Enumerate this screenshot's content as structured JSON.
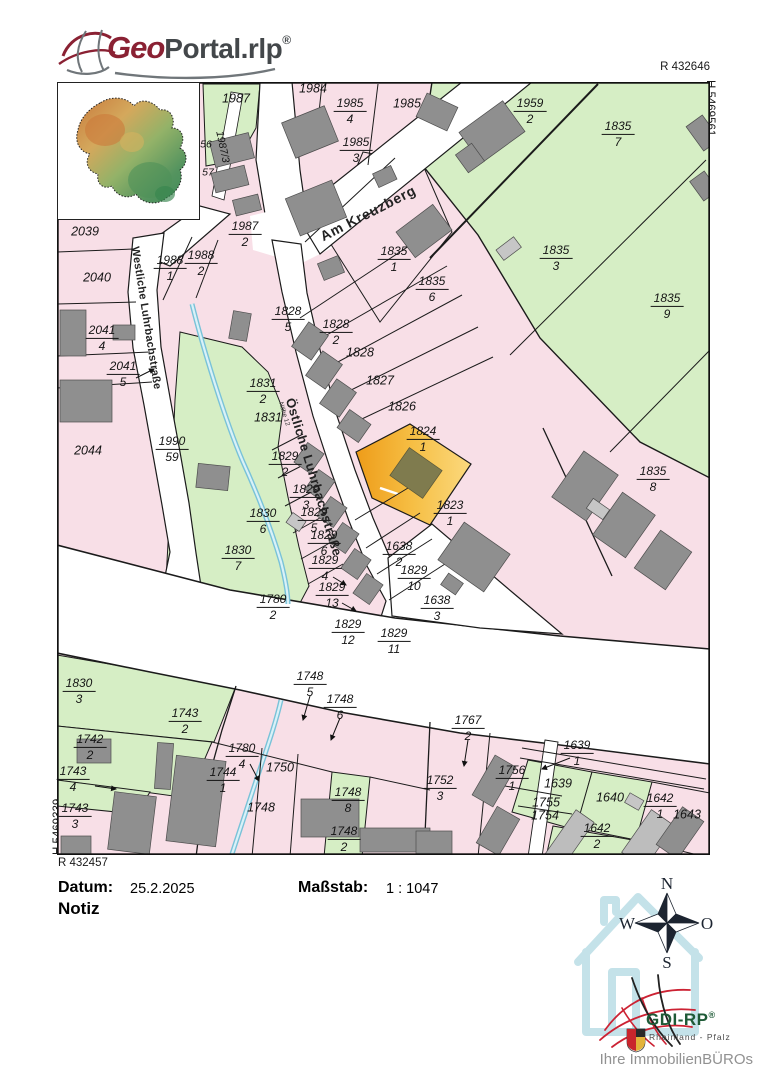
{
  "header": {
    "geo": "Geo",
    "portal": "Portal.rlp",
    "reg": "®"
  },
  "map": {
    "coords": {
      "top_r": "R 432646",
      "right_h": "H 5469561",
      "left_h": "H 5469339",
      "bottom_r": "R 432457"
    },
    "streets": {
      "am_kreuzberg": "Am Kreuzberg",
      "westliche": "Westliche Luhrbachstraße",
      "oestliche": "Östliche Luhrbachstraße",
      "naehe": "Nähe 12"
    },
    "highlight_parcel": "1824/1",
    "parcels": {
      "p1987": {
        "num": "1987"
      },
      "p1984": {
        "num": "1984"
      },
      "p1985_4": {
        "num": "1985",
        "den": "4"
      },
      "p1985": {
        "num": "1985"
      },
      "p1985_3": {
        "num": "1985",
        "den": "3"
      },
      "p1959_2": {
        "num": "1959",
        "den": "2"
      },
      "p1835_7": {
        "num": "1835",
        "den": "7"
      },
      "p1987_3": {
        "num": "1987/3"
      },
      "p56": {
        "num": "56"
      },
      "p57": {
        "num": "57"
      },
      "p2039": {
        "num": "2039"
      },
      "p1987_2": {
        "num": "1987",
        "den": "2"
      },
      "p1988_1": {
        "num": "1988",
        "den": "1"
      },
      "p1988_2": {
        "num": "1988",
        "den": "2"
      },
      "p2040": {
        "num": "2040"
      },
      "p1835_1": {
        "num": "1835",
        "den": "1"
      },
      "p1835_6": {
        "num": "1835",
        "den": "6"
      },
      "p1835_3": {
        "num": "1835",
        "den": "3"
      },
      "p1835_9": {
        "num": "1835",
        "den": "9"
      },
      "p1828_5": {
        "num": "1828",
        "den": "5"
      },
      "p1828_2": {
        "num": "1828",
        "den": "2"
      },
      "p1828": {
        "num": "1828"
      },
      "p2041_4": {
        "num": "2041",
        "den": "4"
      },
      "p1827": {
        "num": "1827"
      },
      "p1831_2": {
        "num": "1831",
        "den": "2"
      },
      "p2041_5": {
        "num": "2041",
        "den": "5"
      },
      "p1826": {
        "num": "1826"
      },
      "p1831": {
        "num": "1831"
      },
      "p1824_1": {
        "num": "1824",
        "den": "1"
      },
      "p2044": {
        "num": "2044"
      },
      "p1990_59": {
        "num": "1990",
        "den": "59"
      },
      "p1829_2": {
        "num": "1829",
        "den": "2"
      },
      "p1829_3": {
        "num": "1829",
        "den": "3"
      },
      "p1829_5": {
        "num": "1829",
        "den": "5"
      },
      "p1829_6": {
        "num": "1829",
        "den": "6"
      },
      "p1830_6": {
        "num": "1830",
        "den": "6"
      },
      "p1830_7": {
        "num": "1830",
        "den": "7"
      },
      "p1829_4": {
        "num": "1829",
        "den": "4"
      },
      "p1829_13": {
        "num": "1829",
        "den": "13"
      },
      "p1780_2": {
        "num": "1780",
        "den": "2"
      },
      "p1829_12": {
        "num": "1829",
        "den": "12"
      },
      "p1638_2": {
        "num": "1638",
        "den": "2"
      },
      "p1829_10": {
        "num": "1829",
        "den": "10"
      },
      "p1638_3": {
        "num": "1638",
        "den": "3"
      },
      "p1829_11": {
        "num": "1829",
        "den": "11"
      },
      "p1823_1": {
        "num": "1823",
        "den": "1"
      },
      "p1835_8": {
        "num": "1835",
        "den": "8"
      },
      "p1830_3": {
        "num": "1830",
        "den": "3"
      },
      "p1743_2": {
        "num": "1743",
        "den": "2"
      },
      "p1742_2": {
        "num": "1742",
        "den": "2"
      },
      "p1743_4": {
        "num": "1743",
        "den": "4"
      },
      "p1743_3": {
        "num": "1743",
        "den": "3"
      },
      "p1744_1": {
        "num": "1744",
        "den": "1"
      },
      "p1780_4": {
        "num": "1780",
        "den": "4"
      },
      "p1750": {
        "num": "1750"
      },
      "p1748": {
        "num": "1748"
      },
      "p1748_5": {
        "num": "1748",
        "den": "5"
      },
      "p1748_6": {
        "num": "1748",
        "den": "6"
      },
      "p1767_2": {
        "num": "1767",
        "den": "2"
      },
      "p1748_8": {
        "num": "1748",
        "den": "8"
      },
      "p1748_2": {
        "num": "1748",
        "den": "2"
      },
      "p1752_3": {
        "num": "1752",
        "den": "3"
      },
      "p1639_1": {
        "num": "1639",
        "den": "1"
      },
      "p1639": {
        "num": "1639"
      },
      "p1640": {
        "num": "1640"
      },
      "p1642_1": {
        "num": "1642",
        "den": "1"
      },
      "p1643": {
        "num": "1643"
      },
      "p1642_2": {
        "num": "1642",
        "den": "2"
      },
      "p1756_1": {
        "num": "1756",
        "den": "1"
      },
      "p1755": {
        "num": "1755"
      },
      "p1754": {
        "num": "1754"
      }
    }
  },
  "footer": {
    "datum_label": "Datum:",
    "datum_value": "25.2.2025",
    "massstab_label": "Maßstab:",
    "massstab_value": "1 : 1047",
    "notiz_label": "Notiz"
  },
  "compass": {
    "n": "N",
    "e": "O",
    "s": "S",
    "w": "W"
  },
  "branding": {
    "gdi_name": "GDI-RP",
    "gdi_reg": "®",
    "gdi_region": "Rheinland - Pfalz",
    "credit": "Ihre ImmobilienBÜROs"
  },
  "colors": {
    "pink": "#f8dfe7",
    "green": "#d6eec5",
    "strip_green": "#e4f3d1",
    "highlight_orange": "#f2ab2e",
    "building_gray": "#8f8f8f",
    "stream_blue": "#79c2d8",
    "logo_red": "#8a2133",
    "gdi_green": "#1e5a36"
  }
}
